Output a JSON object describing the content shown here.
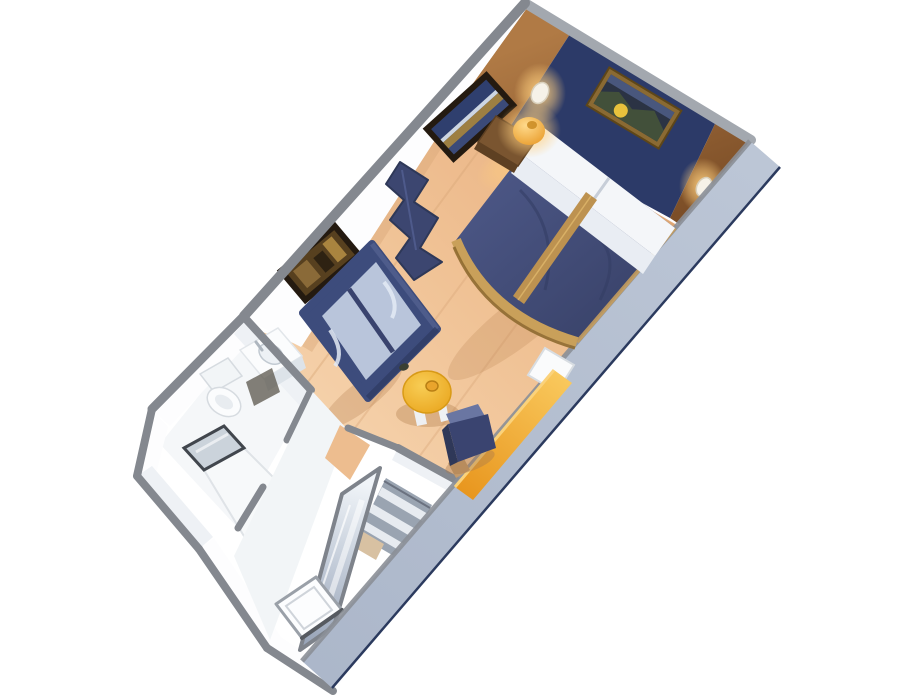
{
  "scene": {
    "type": "3d-cutaway-floorplan",
    "subject": "cruise ship stateroom 3D floor plan",
    "rooms": [
      "bedroom-living-area",
      "bathroom",
      "wardrobe-corridor"
    ],
    "labels": {
      "room": "stateroom-cutaway-floorplan",
      "bed": "double-bed",
      "pillows": "pillows",
      "runner": "bed-runner",
      "nightstand": "nightstand",
      "lamp": "table-lamp",
      "sconce": "wall-sconce",
      "art_bed": "artwork-above-bed",
      "art_seascape": "seascape-artwork",
      "art_sofa": "artwork-above-sofa",
      "sofa": "sofa",
      "partition": "decorative-partition",
      "table": "coffee-table",
      "desk": "vanity-desk",
      "chair": "desk-chair",
      "wardrobe": "mirrored-wardrobe",
      "shelves": "closet-shelves",
      "bathroom": "bathroom",
      "toilet": "toilet",
      "vanity": "vanity-sink",
      "shower": "shower",
      "door": "entry-door"
    }
  },
  "colors": {
    "page_bg": "#ffffff",
    "wall_cap": "#84888f",
    "wall_cap_light": "#a3a8af",
    "wall_face": "#fdfdfe",
    "wall_face_shade": "#eef1f5",
    "cut_band_edge": "#2b3a5e",
    "navy_panel": "#2c3a68",
    "art_frame_dark": "#241a10",
    "art_frame_gold": "#8a6a33",
    "pillow": "#f4f6f9",
    "sheet_fold": "#e9edf3",
    "runner_gold": "#bd9250",
    "bed_trim_gold": "#c9a05a",
    "nightstand_wood": "#7a5530",
    "sofa_navy": "#3d4c7c",
    "cushion_blue": "#b9c5db",
    "partition_navy": "#3c4670",
    "chair_navy": "#3a4470",
    "chair_highlight": "#6a76a2",
    "bathroom_floor": "#f5f7f9",
    "corridor_floor": "#f2f5f7",
    "fixture_white": "#fbfcfd",
    "fixture_shade": "#dde3e9",
    "dark_gap": "#5a554b",
    "mat_beige": "#d8c1a2",
    "door_white": "#fcfdfe",
    "drain_dark": "#4a4f55",
    "remote_dark": "#3a3f33",
    "shelf_gray": "#9aa4b1",
    "shelf_stripe": "#e7ebf0",
    "shadow_warm": "#b07a4a",
    "wedge_tan": "#edbd8f",
    "white_bench": "#fafbfc"
  }
}
